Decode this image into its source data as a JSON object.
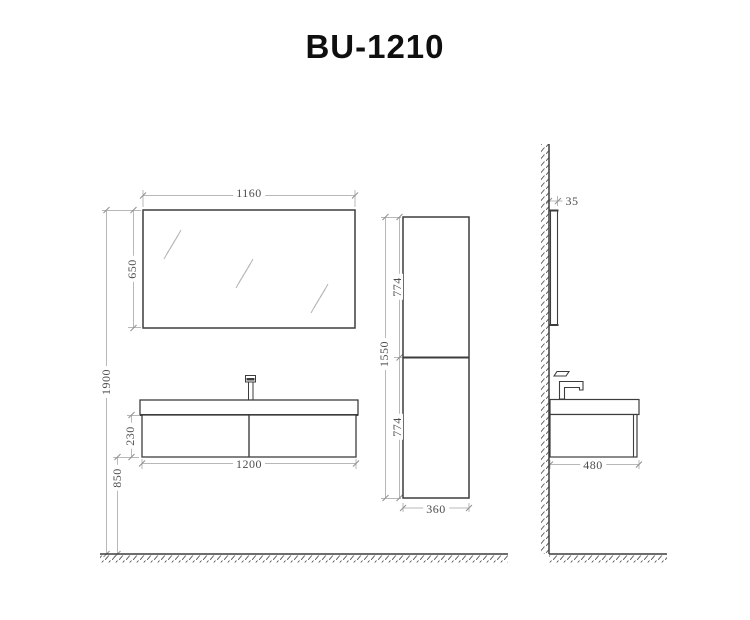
{
  "title": "BU-1210",
  "dims": {
    "front": {
      "mirror_width": "1160",
      "mirror_height": "650",
      "total_height": "1900",
      "cabinet_height": "230",
      "floor_clearance": "850",
      "cabinet_width": "1200"
    },
    "column": {
      "upper_door": "774",
      "lower_door": "774",
      "total_height": "1550",
      "width": "360"
    },
    "side": {
      "mirror_depth": "35",
      "cabinet_depth": "480"
    }
  },
  "colors": {
    "outline": "#3d3d3d",
    "dim_line": "#b8b8b8",
    "dim_text": "#4d4d4d",
    "title_text": "#0f0f0f",
    "hatch": "#555555"
  }
}
